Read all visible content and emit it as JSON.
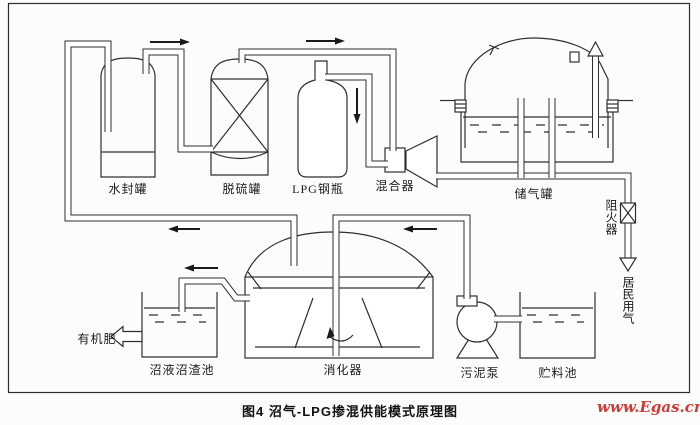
{
  "figure": {
    "caption": "图4 沼气-LPG掺混供能模式原理图",
    "watermark": "www.Egas.cn"
  },
  "labels": {
    "water_seal_tank": "水封罐",
    "desulfurizer_tank": "脱硫罐",
    "lpg_cylinder": "LPG钢瓶",
    "mixer": "混合器",
    "gas_storage_tank": "储气罐",
    "flame_arrester": "阻火器",
    "residential_gas": "居民用气",
    "organic_fertilizer": "有机肥",
    "slurry_residue_pool": "沼液沼渣池",
    "digester": "消化器",
    "sludge_pump": "污泥泵",
    "feedstock_pool": "贮料池"
  },
  "colors": {
    "line": "#2f2f2f",
    "watermark_red": "#cc3b3b",
    "paper": "#fcfcfb"
  }
}
